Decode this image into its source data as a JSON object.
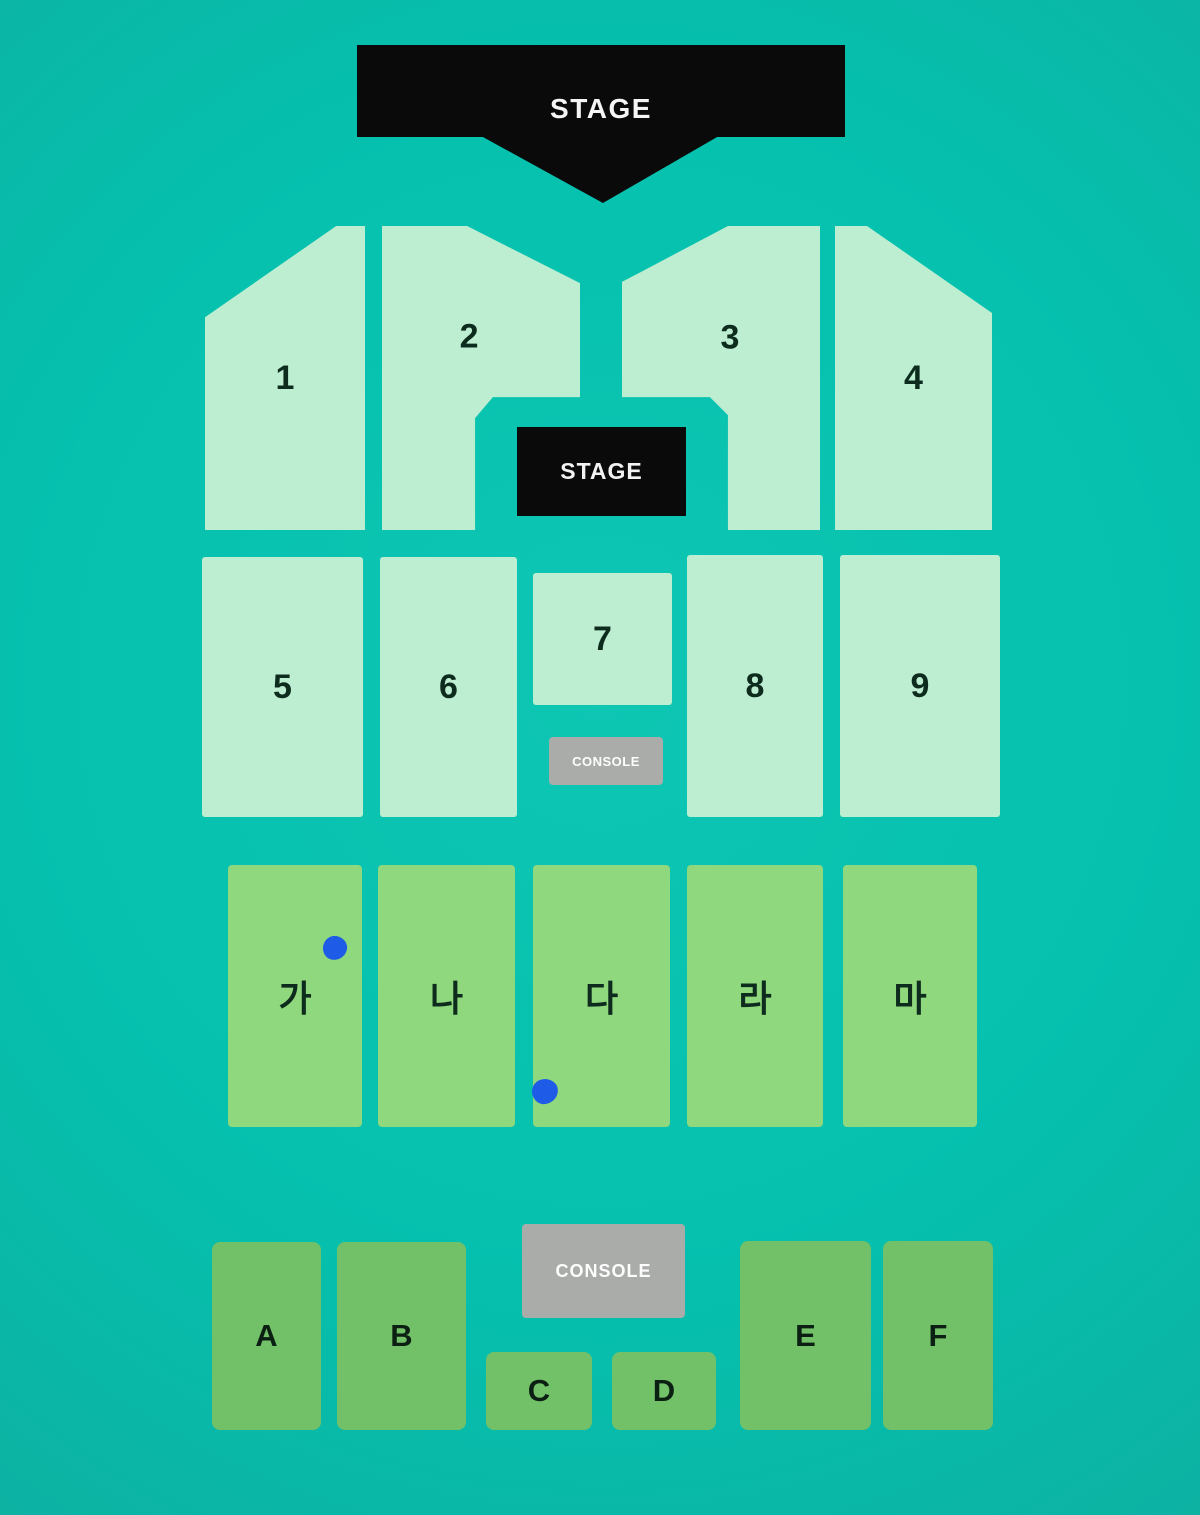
{
  "colors": {
    "background_teal": "#07c2af",
    "floor_section_mint": "#bdeed2",
    "middle_section_green": "#90d87d",
    "rear_section_green": "#72c068",
    "console_gray": "#a9aca9",
    "stage_black": "#0a0a0a",
    "seat_marker_blue": "#1e5ce8"
  },
  "stage": {
    "banner_label": "STAGE",
    "inner_label": "STAGE"
  },
  "consoles": {
    "upper_label": "CONSOLE",
    "lower_label": "CONSOLE"
  },
  "floor_sections": [
    "1",
    "2",
    "3",
    "4",
    "5",
    "6",
    "7",
    "8",
    "9"
  ],
  "middle_sections": [
    "가",
    "나",
    "다",
    "라",
    "마"
  ],
  "rear_sections": [
    "A",
    "B",
    "C",
    "D",
    "E",
    "F"
  ],
  "seat_markers": [
    {
      "section": "가"
    },
    {
      "section": "다"
    }
  ]
}
